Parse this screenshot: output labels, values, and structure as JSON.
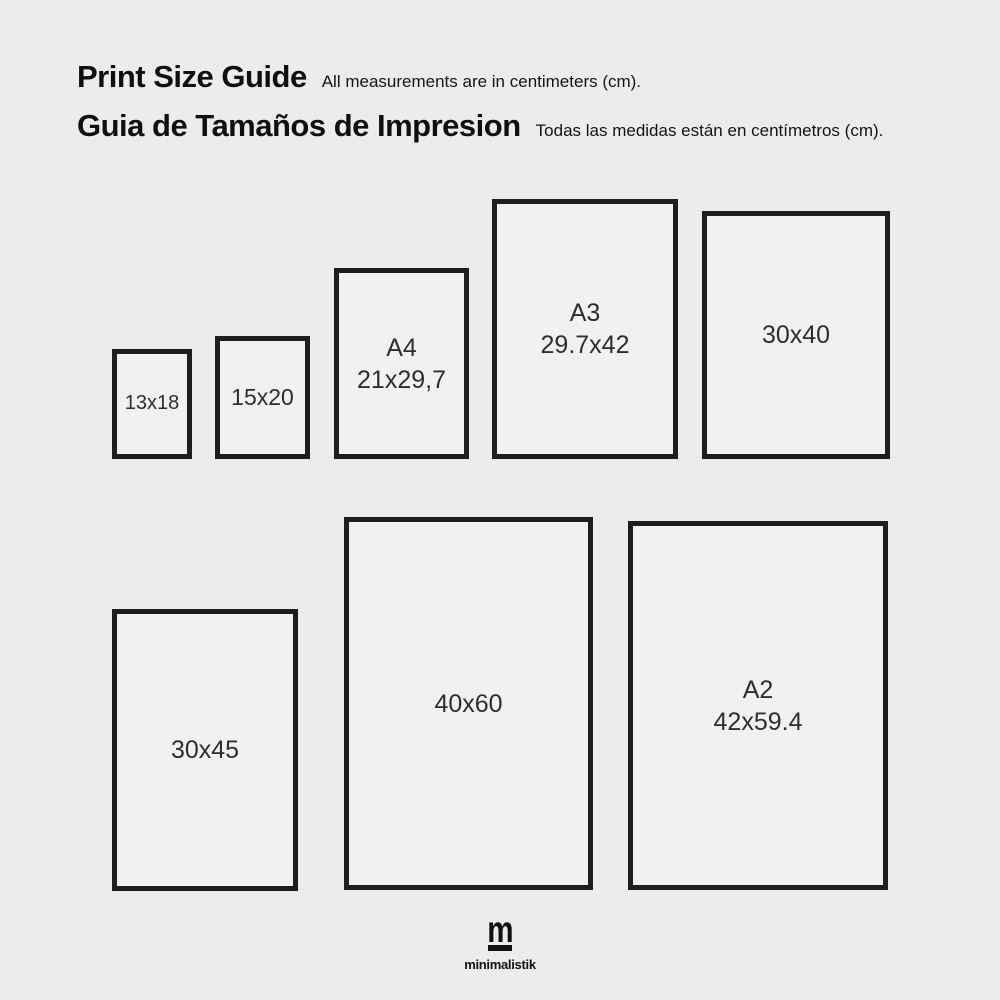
{
  "colors": {
    "background": "#ececec",
    "frame_border": "#1e1e1e",
    "box_fill": "#f1f1f1",
    "heading_text": "#0f0f0f",
    "label_text": "#2e2e2e"
  },
  "header": {
    "title_en": "Print Size Guide",
    "subtitle_en": "All measurements are in centimeters (cm).",
    "title_es": "Guia de Tamaños de Impresion",
    "subtitle_es": "Todas las medidas están en centímetros (cm)."
  },
  "sizes": [
    {
      "id": "13x18",
      "line1": "",
      "line2": "13x18"
    },
    {
      "id": "15x20",
      "line1": "",
      "line2": "15x20"
    },
    {
      "id": "a4",
      "line1": "A4",
      "line2": "21x29,7"
    },
    {
      "id": "a3",
      "line1": "A3",
      "line2": "29.7x42"
    },
    {
      "id": "30x40",
      "line1": "",
      "line2": "30x40"
    },
    {
      "id": "30x45",
      "line1": "",
      "line2": "30x45"
    },
    {
      "id": "40x60",
      "line1": "",
      "line2": "40x60"
    },
    {
      "id": "a2",
      "line1": "A2",
      "line2": "42x59.4"
    }
  ],
  "logo": {
    "mark": "m",
    "wordmark": "minimalistik"
  }
}
